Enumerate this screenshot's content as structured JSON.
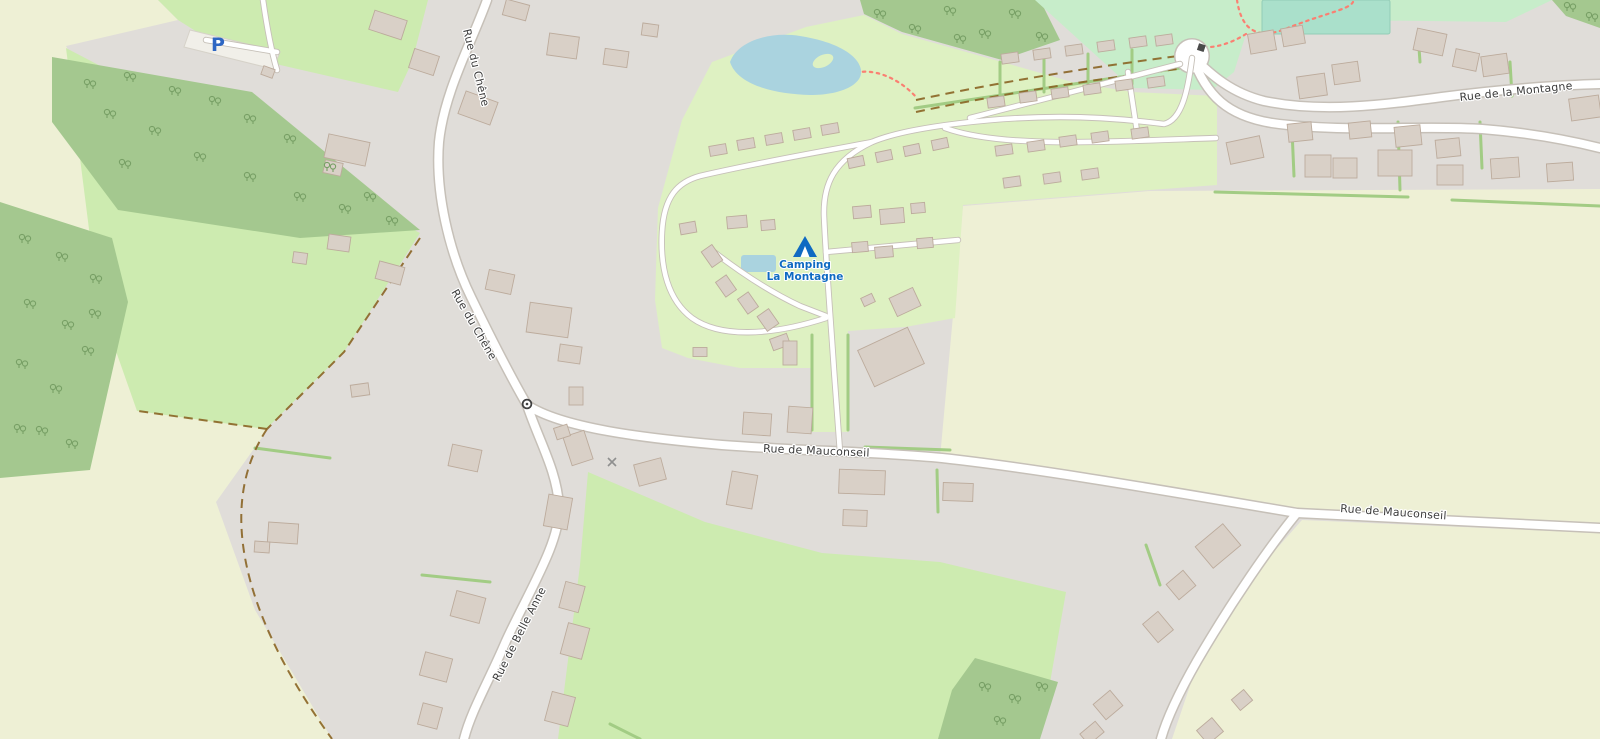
{
  "map": {
    "kind": "street-map-tile",
    "labels": {
      "rue_du_chene": "Rue du Chêne",
      "rue_de_mauconseil": "Rue de Mauconseil",
      "rue_de_belle_anne": "Rue de Belle Anne",
      "rue_de_la_montagne": "Rue de la Montagne",
      "camping_line1": "Camping",
      "camping_line2": "La Montagne",
      "parking_symbol": "P"
    },
    "icons": {
      "tent_icon": "campsite tent",
      "parking_p_icon": "parking",
      "mini_roundabout_icon": "junction circle",
      "gate_icon": "gate",
      "pole_icon": "small cross marker",
      "tree_icon": "deciduous tree pair"
    }
  },
  "palette": {
    "residential": "#e0ddd9",
    "meadow": "#cdebb0",
    "farmland": "#eef0d5",
    "forest": "#a4c88f",
    "tree": "#78a066",
    "campsite": "#def1c2",
    "park": "#c7edca",
    "pitch": "#aae0cb",
    "water": "#aad3df",
    "road_fill": "#ffffff",
    "road_casing": "#c6c0b8",
    "building_fill": "#d9d0c7",
    "building_stroke": "#bcab9c",
    "hedge": "#a2cc84",
    "track": "#8a6424",
    "footpath": "#fa8072",
    "street_label": "#3c3c3c",
    "poi_blue": "#0f6ac2",
    "parking_area": "#f1efe9",
    "parking_blue": "#2e66c3"
  }
}
